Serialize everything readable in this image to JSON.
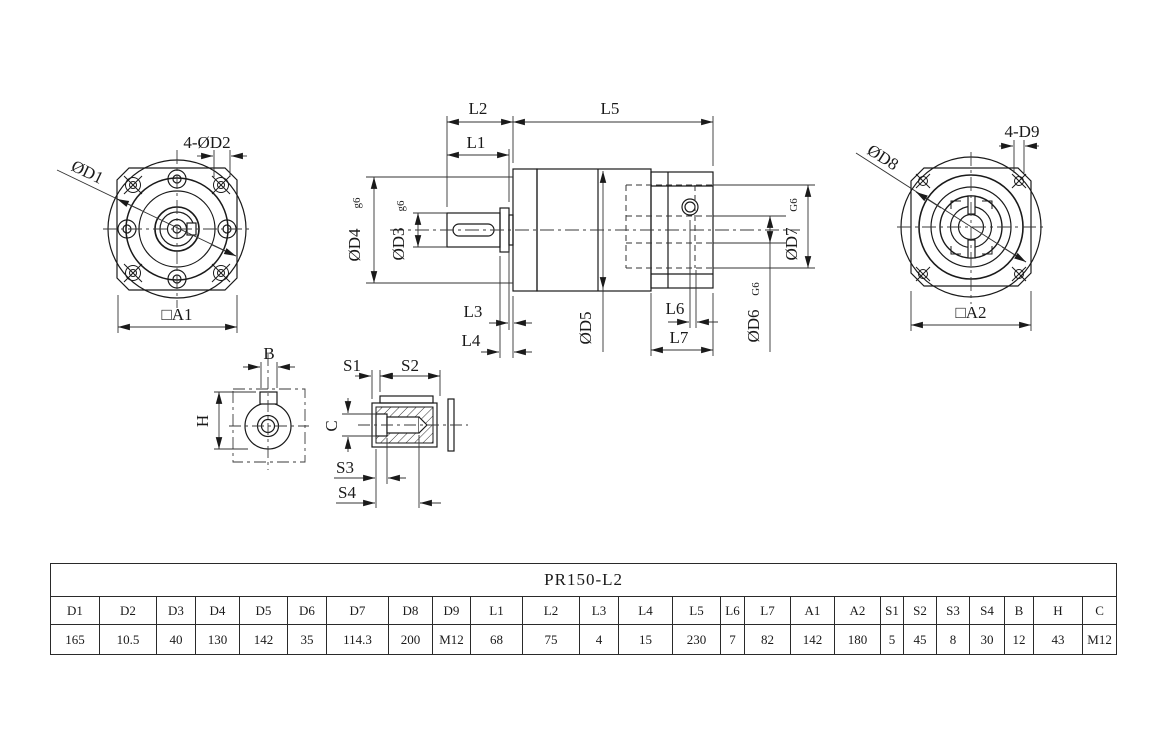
{
  "views": {
    "front": {
      "dia_label": "ØD1",
      "holes_label": "4-ØD2",
      "square_label": "□A1"
    },
    "side": {
      "l1": "L1",
      "l2": "L2",
      "l3": "L3",
      "l4": "L4",
      "l5": "L5",
      "l6": "L6",
      "l7": "L7",
      "d3": "ØD3",
      "d3_fit": "g6",
      "d4": "ØD4",
      "d4_fit": "g6",
      "d5": "ØD5",
      "d6": "ØD6",
      "d6_fit": "G6",
      "d7": "ØD7",
      "d7_fit": "G6"
    },
    "rear": {
      "dia_label": "ØD8",
      "holes_label": "4-D9",
      "square_label": "□A2"
    },
    "shaft_end": {
      "width_label": "B",
      "height_label": "H"
    },
    "shaft_section": {
      "s1": "S1",
      "s2": "S2",
      "s3": "S3",
      "s4": "S4",
      "c": "C"
    }
  },
  "table": {
    "title": "PR150-L2",
    "headers": [
      "D1",
      "D2",
      "D3",
      "D4",
      "D5",
      "D6",
      "D7",
      "D8",
      "D9",
      "L1",
      "L2",
      "L3",
      "L4",
      "L5",
      "L6",
      "L7",
      "A1",
      "A2",
      "S1",
      "S2",
      "S3",
      "S4",
      "B",
      "H",
      "C"
    ],
    "values": [
      "165",
      "10.5",
      "40",
      "130",
      "142",
      "35",
      "114.3",
      "200",
      "M12",
      "68",
      "75",
      "4",
      "15",
      "230",
      "7",
      "82",
      "142",
      "180",
      "5",
      "45",
      "8",
      "30",
      "12",
      "43",
      "M12"
    ],
    "col_widths": [
      49,
      57,
      39,
      44,
      48,
      39,
      62,
      44,
      38,
      52,
      57,
      39,
      54,
      48,
      24,
      46,
      44,
      46,
      23,
      33,
      33,
      35,
      29,
      49,
      34
    ]
  },
  "colors": {
    "line": "#1a1a1a",
    "background": "#ffffff"
  }
}
